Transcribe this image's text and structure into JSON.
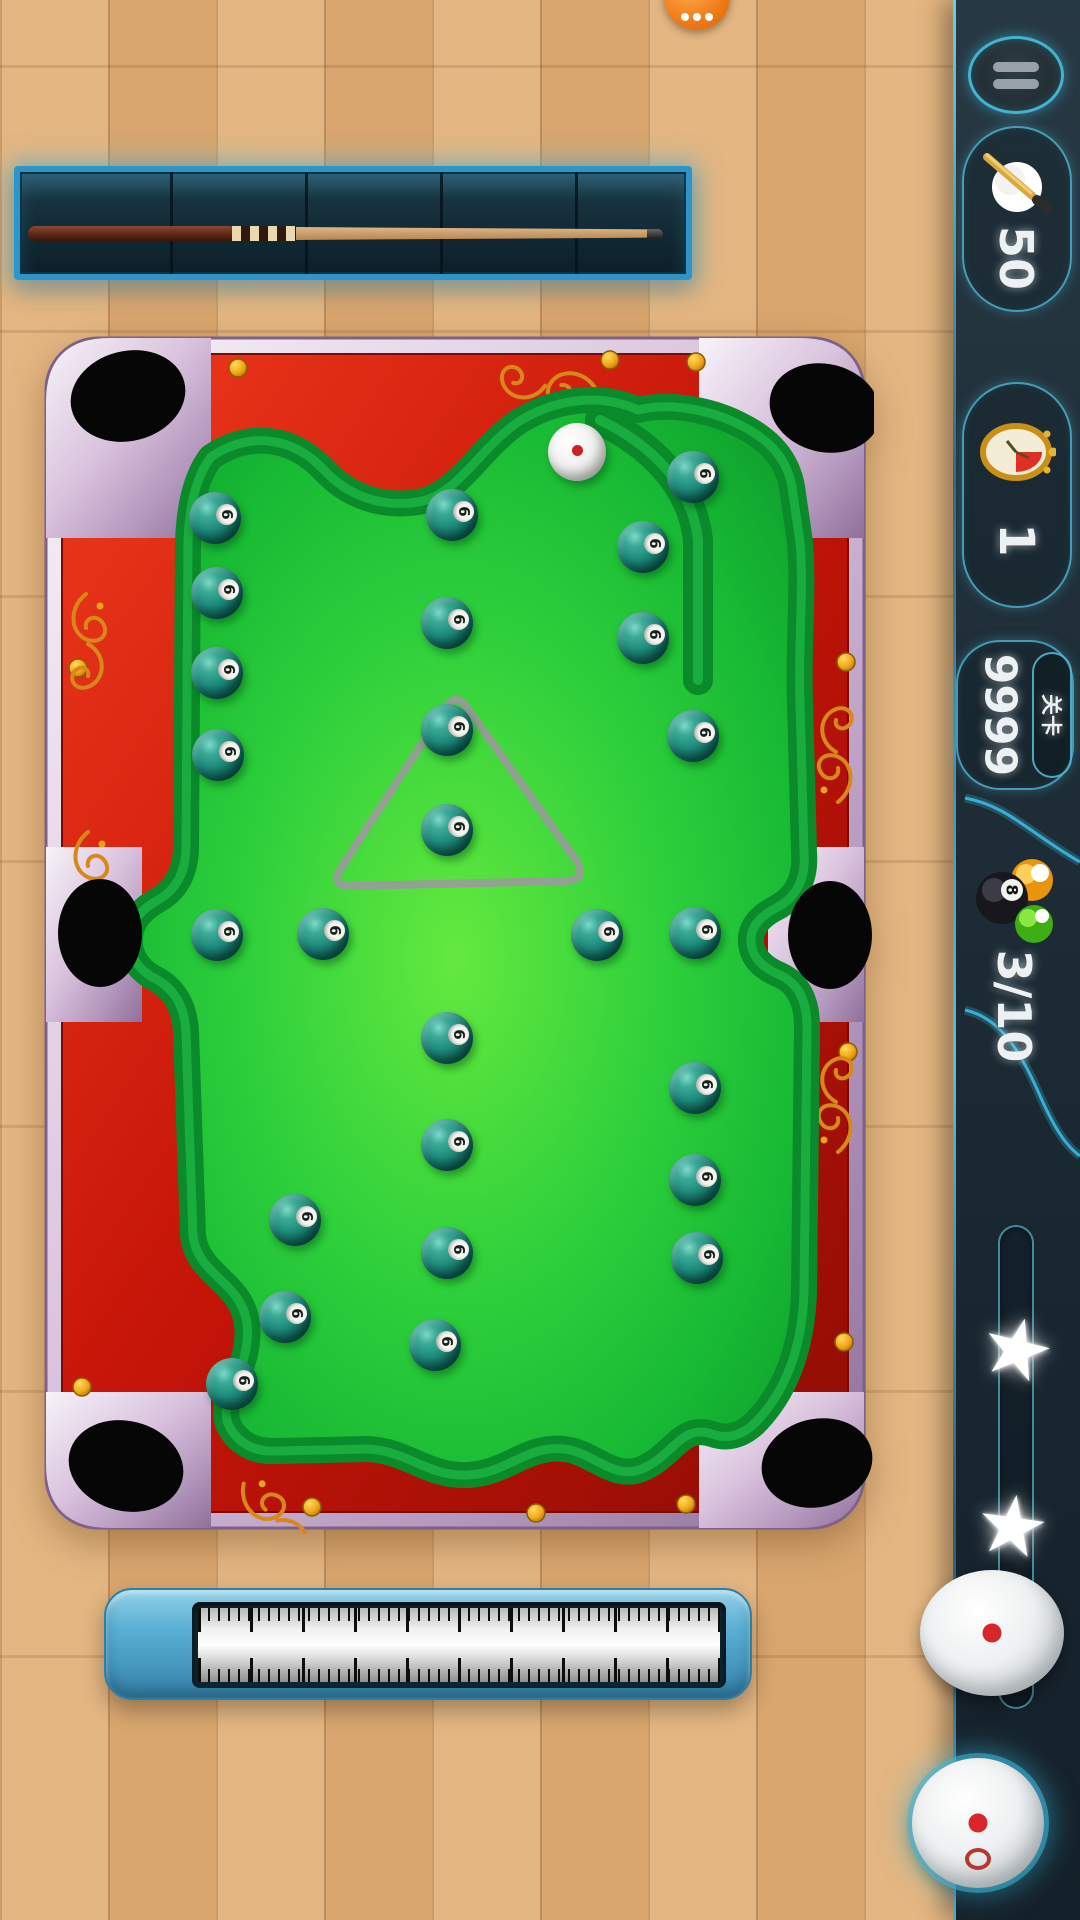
{
  "hud": {
    "cue_coin_value": "50",
    "timer_value": "1",
    "level_value": "9999",
    "level_label": "关卡",
    "balls_counter": "3/10",
    "stars_count": 2,
    "star_glyph": "★"
  },
  "table": {
    "ball_number": "6",
    "cue_ball": {
      "x": 577,
      "y": 452
    },
    "balls": [
      {
        "x": 215,
        "y": 518
      },
      {
        "x": 452,
        "y": 515
      },
      {
        "x": 693,
        "y": 477
      },
      {
        "x": 643,
        "y": 547
      },
      {
        "x": 217,
        "y": 593
      },
      {
        "x": 447,
        "y": 623
      },
      {
        "x": 643,
        "y": 638
      },
      {
        "x": 217,
        "y": 673
      },
      {
        "x": 447,
        "y": 730
      },
      {
        "x": 693,
        "y": 736
      },
      {
        "x": 218,
        "y": 755
      },
      {
        "x": 447,
        "y": 830
      },
      {
        "x": 217,
        "y": 935
      },
      {
        "x": 323,
        "y": 934
      },
      {
        "x": 597,
        "y": 935
      },
      {
        "x": 695,
        "y": 933
      },
      {
        "x": 447,
        "y": 1038
      },
      {
        "x": 695,
        "y": 1088
      },
      {
        "x": 447,
        "y": 1145
      },
      {
        "x": 695,
        "y": 1180
      },
      {
        "x": 295,
        "y": 1220
      },
      {
        "x": 447,
        "y": 1253
      },
      {
        "x": 697,
        "y": 1258
      },
      {
        "x": 285,
        "y": 1317
      },
      {
        "x": 435,
        "y": 1345
      },
      {
        "x": 232,
        "y": 1384
      }
    ]
  },
  "colors": {
    "accent_cyan": "#3fc6e8",
    "rail_red": "#c81408",
    "felt_green": "#2fd03c",
    "gold": "#f0a818",
    "sidebar_bg": "#20303a"
  }
}
